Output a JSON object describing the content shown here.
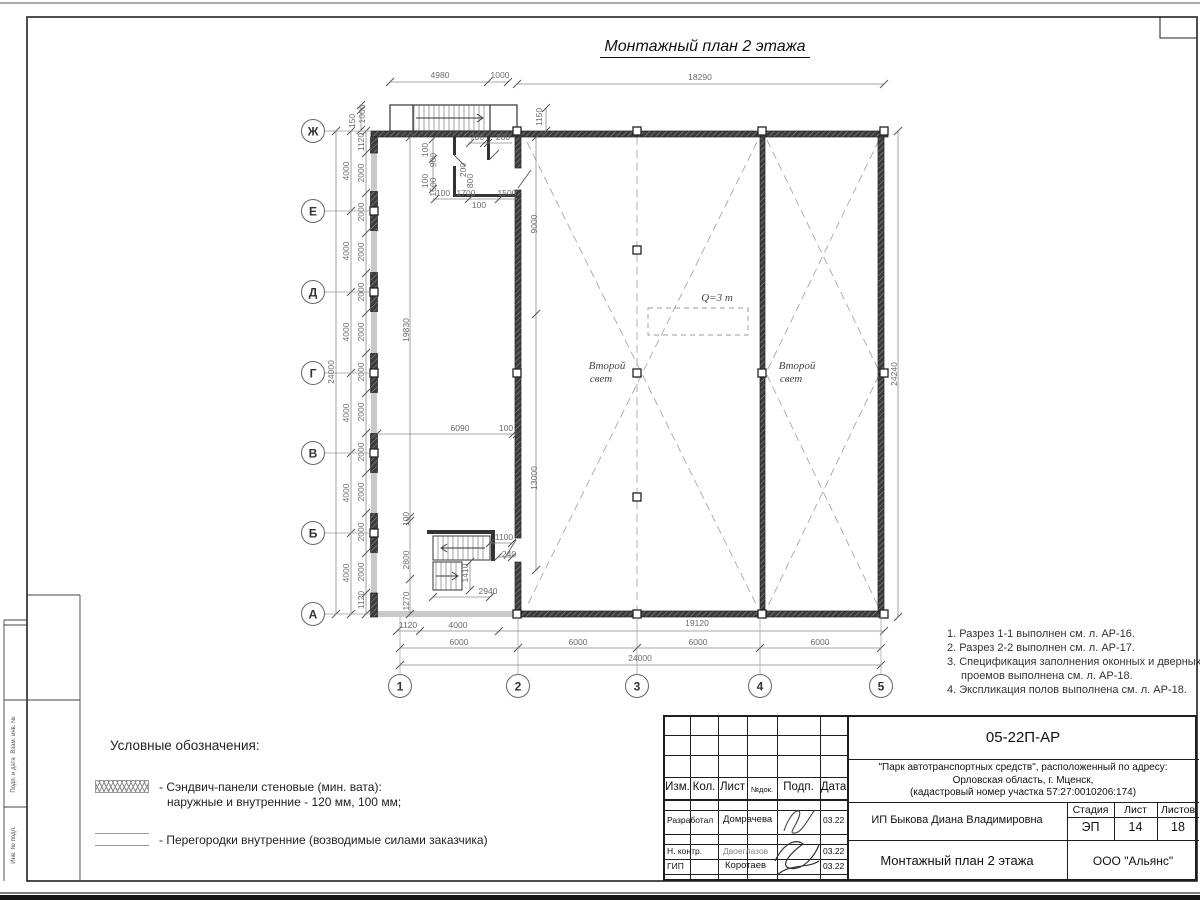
{
  "sheet": {
    "title": "Монтажный план 2 этажа",
    "margin_labels": [
      "Взам. инв. №",
      "Подп. и дата",
      "Инв. № подл."
    ]
  },
  "notes": {
    "items": [
      "1. Разрез 1-1 выполнен см. л. АР-16.",
      "2. Разрез 2-2 выполнен см. л. АР-17.",
      "3. Спецификация заполнения оконных и дверных проемов выполнена см. л. АР-18.",
      "4. Экспликация полов выполнена см. л. АР-18."
    ]
  },
  "legend": {
    "title": "Условные обозначения:",
    "item1_line1": "- Сэндвич-панели стеновые (мин. вата):",
    "item1_line2": "наружные и внутренние - 120 мм, 100 мм;",
    "item2_text": "- Перегородки внутренние (возводимые силами заказчика)"
  },
  "stamp": {
    "doc_number": "05-22П-АР",
    "project_line1": "\"Парк автотранспортных средств\",  расположенный по адресу:",
    "project_line2": "Орловская область, г. Мценск,",
    "project_line3": "(кадастровый номер участка 57:27:0010206:174)",
    "col_izm": "Изм.",
    "col_kol": "Кол.",
    "col_list": "Лист",
    "col_ndok": "№док.",
    "col_podp": "Подп.",
    "col_data": "Дата",
    "rows": [
      {
        "role": "Разработал",
        "name": "Домрачева",
        "date": "03.22"
      },
      {
        "role": "Н. контр.",
        "name": "Двоеглазов",
        "date": "03.22"
      },
      {
        "role": "ГИП",
        "name": "Коротаев",
        "date": "03.22"
      }
    ],
    "client": "ИП Быкова Диана Владимировна",
    "stage_label": "Стадия",
    "sheet_label": "Лист",
    "sheets_label": "Листов",
    "stage": "ЭП",
    "sheet_no": "14",
    "sheets_total": "18",
    "drawing_name": "Монтажный план 2 этажа",
    "company": "ООО \"Альянс\""
  },
  "plan": {
    "grid": {
      "letters": [
        {
          "label": "Ж",
          "y": 131
        },
        {
          "label": "Е",
          "y": 211
        },
        {
          "label": "Д",
          "y": 292
        },
        {
          "label": "Г",
          "y": 373
        },
        {
          "label": "В",
          "y": 453
        },
        {
          "label": "Б",
          "y": 533
        },
        {
          "label": "А",
          "y": 614
        }
      ],
      "numbers": [
        {
          "label": "1",
          "x": 400
        },
        {
          "label": "2",
          "x": 518
        },
        {
          "label": "3",
          "x": 637
        },
        {
          "label": "4",
          "x": 760
        },
        {
          "label": "5",
          "x": 881
        }
      ]
    },
    "labels": [
      {
        "t": "Q=3 т",
        "x": 717,
        "y": 301
      },
      {
        "t": "Второй",
        "x": 607,
        "y": 369
      },
      {
        "t": "свет",
        "x": 601,
        "y": 382
      },
      {
        "t": "Второй",
        "x": 797,
        "y": 369
      },
      {
        "t": "свет",
        "x": 791,
        "y": 382
      }
    ],
    "dimensions": [
      {
        "t": "4980",
        "x": 440,
        "y": 78
      },
      {
        "t": "1000",
        "x": 500,
        "y": 78
      },
      {
        "t": "18290",
        "x": 700,
        "y": 80
      },
      {
        "t": "150",
        "x": 355,
        "y": 121,
        "r": 1
      },
      {
        "t": "1000",
        "x": 365,
        "y": 114,
        "r": 1
      },
      {
        "t": "1150",
        "x": 542,
        "y": 117,
        "r": 1
      },
      {
        "t": "24000",
        "x": 334,
        "y": 372,
        "r": 1
      },
      {
        "t": "4000",
        "x": 349,
        "y": 171,
        "r": 1
      },
      {
        "t": "4000",
        "x": 349,
        "y": 251,
        "r": 1
      },
      {
        "t": "4000",
        "x": 349,
        "y": 332,
        "r": 1
      },
      {
        "t": "4000",
        "x": 349,
        "y": 413,
        "r": 1
      },
      {
        "t": "4000",
        "x": 349,
        "y": 493,
        "r": 1
      },
      {
        "t": "4000",
        "x": 349,
        "y": 573,
        "r": 1
      },
      {
        "t": "1120",
        "x": 364,
        "y": 142,
        "r": 1
      },
      {
        "t": "2000",
        "x": 364,
        "y": 173,
        "r": 1
      },
      {
        "t": "2000",
        "x": 364,
        "y": 212,
        "r": 1
      },
      {
        "t": "2000",
        "x": 364,
        "y": 252,
        "r": 1
      },
      {
        "t": "2000",
        "x": 364,
        "y": 292,
        "r": 1
      },
      {
        "t": "2000",
        "x": 364,
        "y": 332,
        "r": 1
      },
      {
        "t": "2000",
        "x": 364,
        "y": 372,
        "r": 1
      },
      {
        "t": "2000",
        "x": 364,
        "y": 412,
        "r": 1
      },
      {
        "t": "2000",
        "x": 364,
        "y": 452,
        "r": 1
      },
      {
        "t": "2000",
        "x": 364,
        "y": 492,
        "r": 1
      },
      {
        "t": "2000",
        "x": 364,
        "y": 532,
        "r": 1
      },
      {
        "t": "2000",
        "x": 364,
        "y": 572,
        "r": 1
      },
      {
        "t": "1120",
        "x": 364,
        "y": 600,
        "r": 1
      },
      {
        "t": "19830",
        "x": 409,
        "y": 330,
        "r": 1
      },
      {
        "t": "100",
        "x": 409,
        "y": 519,
        "r": 1
      },
      {
        "t": "2800",
        "x": 409,
        "y": 560,
        "r": 1
      },
      {
        "t": "1270",
        "x": 409,
        "y": 601,
        "r": 1
      },
      {
        "t": "9000",
        "x": 537,
        "y": 224,
        "r": 1
      },
      {
        "t": "13000",
        "x": 537,
        "y": 478,
        "r": 1
      },
      {
        "t": "24240",
        "x": 897,
        "y": 374,
        "r": 1
      },
      {
        "t": "700",
        "x": 477,
        "y": 140
      },
      {
        "t": "200",
        "x": 503,
        "y": 140
      },
      {
        "t": "100",
        "x": 428,
        "y": 150,
        "r": 1
      },
      {
        "t": "900",
        "x": 436,
        "y": 160,
        "r": 1
      },
      {
        "t": "100",
        "x": 428,
        "y": 181,
        "r": 1
      },
      {
        "t": "1500",
        "x": 436,
        "y": 187,
        "r": 1
      },
      {
        "t": "200",
        "x": 466,
        "y": 170,
        "r": 1
      },
      {
        "t": "800",
        "x": 473,
        "y": 181,
        "r": 1
      },
      {
        "t": "100",
        "x": 443,
        "y": 196
      },
      {
        "t": "1700",
        "x": 466,
        "y": 196
      },
      {
        "t": "1500",
        "x": 507,
        "y": 196
      },
      {
        "t": "100",
        "x": 479,
        "y": 208
      },
      {
        "t": "6090",
        "x": 460,
        "y": 431
      },
      {
        "t": "100",
        "x": 506,
        "y": 431
      },
      {
        "t": "1100",
        "x": 504,
        "y": 540
      },
      {
        "t": "240",
        "x": 509,
        "y": 557
      },
      {
        "t": "1410",
        "x": 468,
        "y": 573,
        "r": 1
      },
      {
        "t": "2940",
        "x": 488,
        "y": 594
      },
      {
        "t": "1120",
        "x": 408,
        "y": 628
      },
      {
        "t": "4000",
        "x": 458,
        "y": 628
      },
      {
        "t": "19120",
        "x": 697,
        "y": 626
      },
      {
        "t": "6000",
        "x": 459,
        "y": 645
      },
      {
        "t": "6000",
        "x": 578,
        "y": 645
      },
      {
        "t": "6000",
        "x": 698,
        "y": 645
      },
      {
        "t": "6000",
        "x": 820,
        "y": 645
      },
      {
        "t": "24000",
        "x": 640,
        "y": 661
      }
    ]
  }
}
